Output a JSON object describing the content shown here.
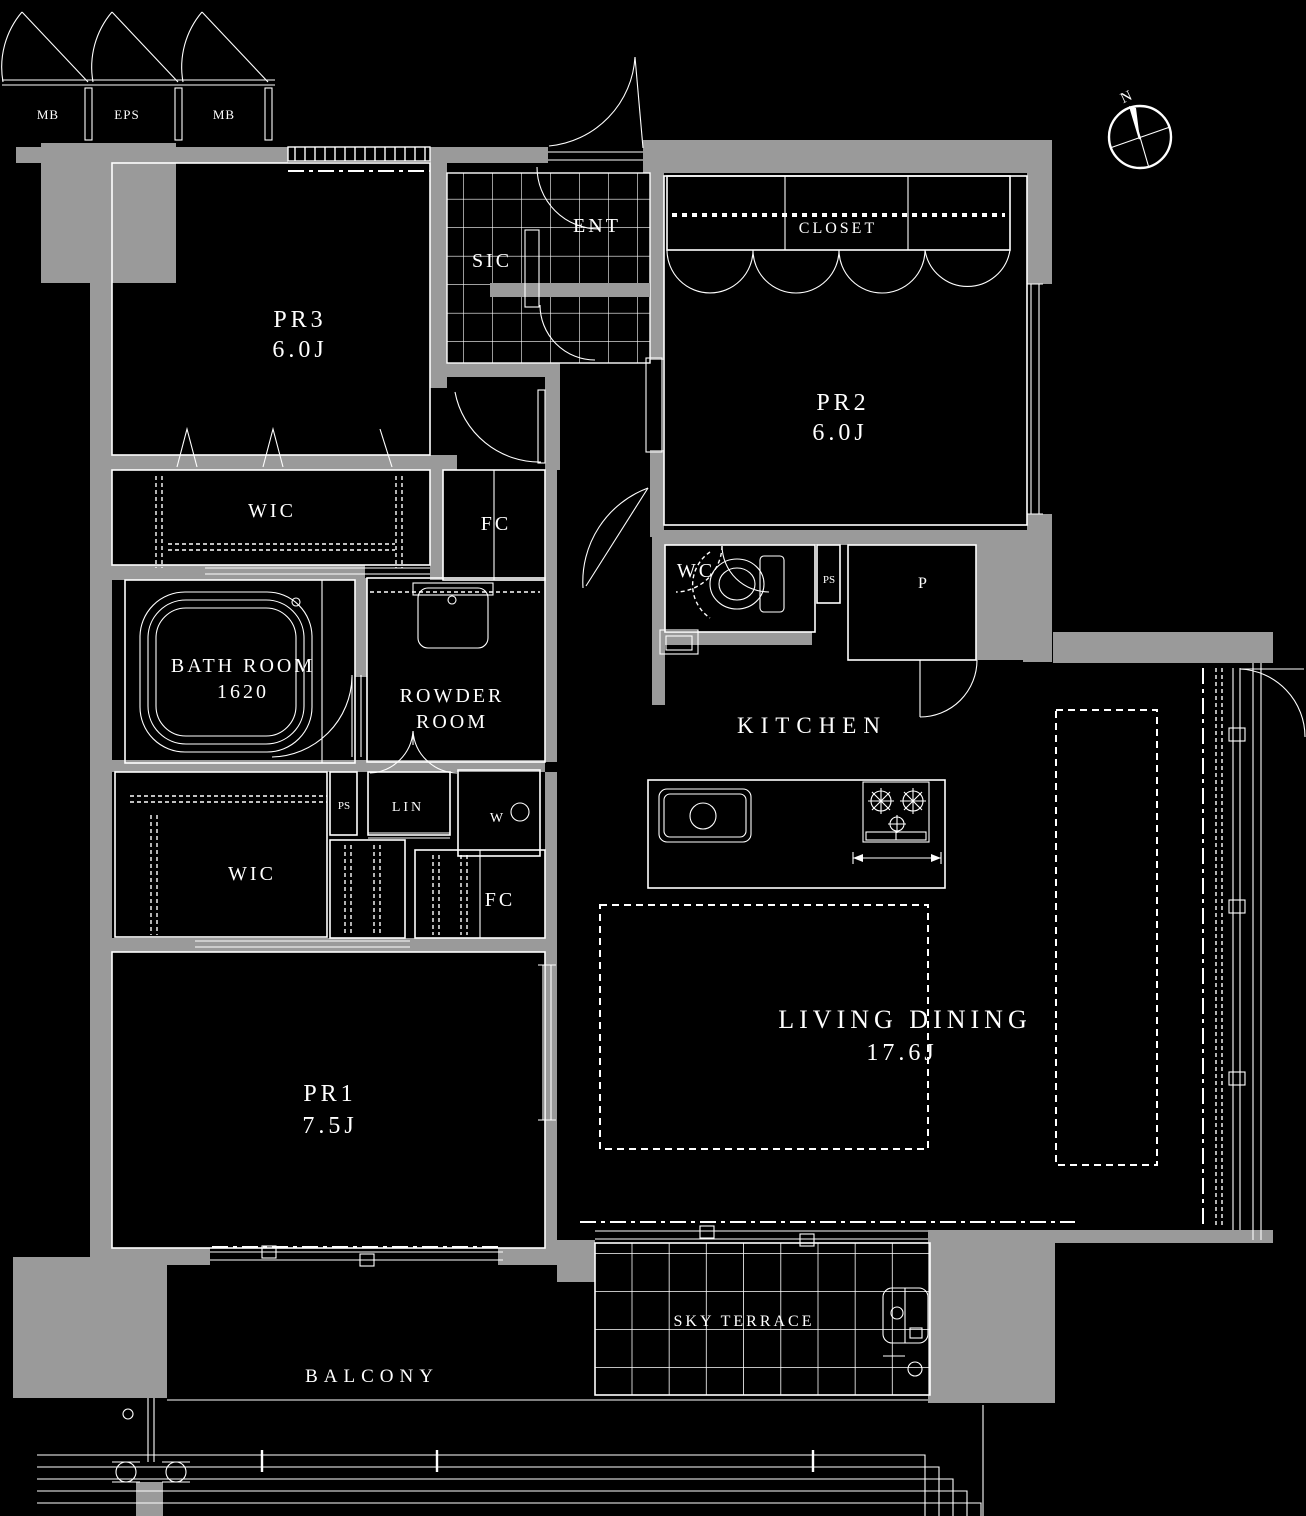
{
  "title": "Apartment floor plan 3LDK",
  "colors": {
    "background": "#000000",
    "wall": "#9a9a9a",
    "line": "#ffffff"
  },
  "compass": {
    "north_label": "N"
  },
  "shafts": {
    "mb_left": "MB",
    "eps": "EPS",
    "mb_right": "MB"
  },
  "entrance": {
    "ent": "ENT",
    "sic": "SIC"
  },
  "rooms": {
    "pr3": {
      "name": "PR3",
      "size": "6.0J"
    },
    "pr2": {
      "name": "PR2",
      "size": "6.0J"
    },
    "pr1": {
      "name": "PR1",
      "size": "7.5J"
    },
    "living_dining": {
      "name": "LIVING DINING",
      "size": "17.6J"
    },
    "kitchen": {
      "name": "KITCHEN"
    },
    "bath": {
      "name": "BATH ROOM",
      "size": "1620"
    },
    "powder": {
      "line1": "ROWDER",
      "line2": "ROOM"
    },
    "wc": {
      "name": "WC"
    }
  },
  "storage": {
    "closet": "CLOSET",
    "wic_upper": "WIC",
    "wic_lower": "WIC",
    "fc_upper": "FC",
    "fc_lower": "FC",
    "lin": "LIN",
    "pantry": "P"
  },
  "utility": {
    "ps_by_wc": "PS",
    "ps_by_lin": "PS",
    "washer": "W"
  },
  "outdoor": {
    "sky_terrace": "SKY TERRACE",
    "balcony": "BALCONY"
  }
}
